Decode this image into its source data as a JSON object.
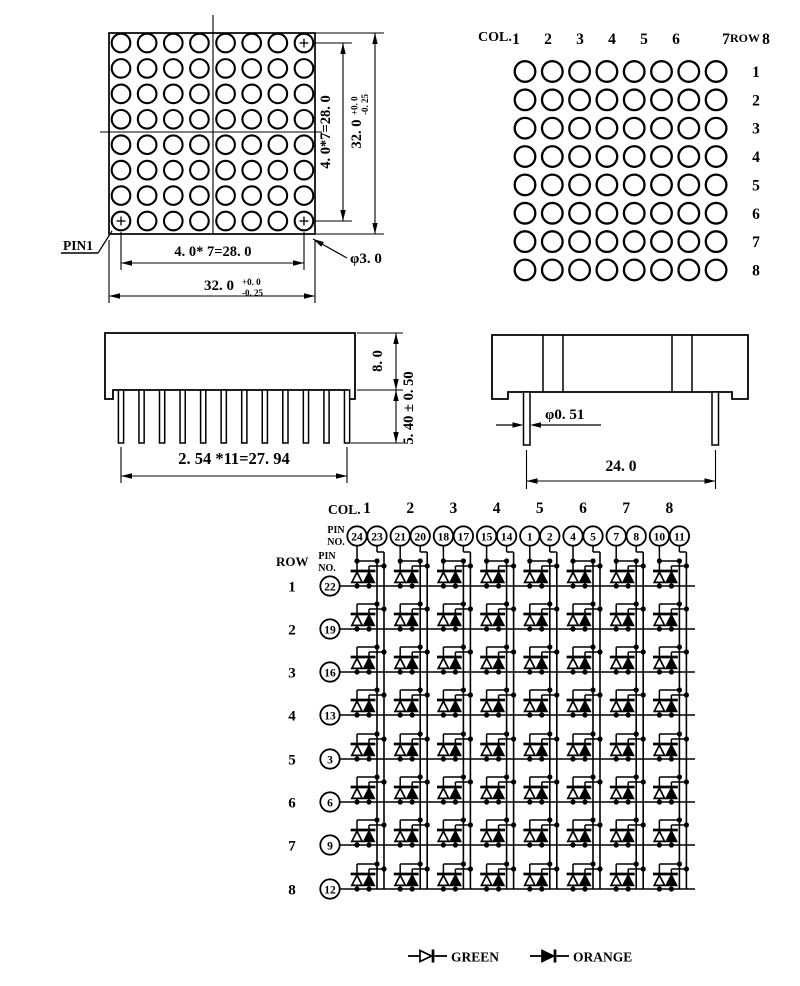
{
  "colors": {
    "ink": "#000000",
    "paper": "#ffffff"
  },
  "front_view": {
    "rows": 8,
    "cols": 8,
    "pin1_label": "PIN1",
    "led_dia": "φ3. 0",
    "dim_row_pitch": "4. 0*7=28. 0",
    "dim_height": "32. 0",
    "dim_height_tol_plus": "+0. 0",
    "dim_height_tol_minus": "-0. 25",
    "dim_col_pitch": "4. 0* 7=28. 0",
    "dim_width": "32. 0",
    "dim_width_tol_plus": "+0. 0",
    "dim_width_tol_minus": "-0. 25"
  },
  "matrix_view": {
    "col_label": "COL.",
    "row_label": "ROW",
    "col_numbers": [
      "1",
      "2",
      "3",
      "4",
      "5",
      "6",
      "7",
      "8"
    ],
    "row_numbers": [
      "1",
      "2",
      "3",
      "4",
      "5",
      "6",
      "7",
      "8"
    ]
  },
  "front_side_view": {
    "pin_count": 12,
    "dim_body_height": "8. 0",
    "dim_pin_length": "5. 40 ± 0. 50",
    "dim_pin_pitch": "2. 54 *11=27. 94"
  },
  "right_side_view": {
    "pin_count": 2,
    "dim_pin_dia": "φ0. 51",
    "dim_pin_span": "24. 0"
  },
  "schematic": {
    "col_label": "COL.",
    "row_label": "ROW",
    "pin_no_label": [
      "PIN",
      "NO."
    ],
    "col_numbers": [
      "1",
      "2",
      "3",
      "4",
      "5",
      "6",
      "7",
      "8"
    ],
    "col_pin_pairs": [
      [
        "24",
        "23"
      ],
      [
        "21",
        "20"
      ],
      [
        "18",
        "17"
      ],
      [
        "15",
        "14"
      ],
      [
        "1",
        "2"
      ],
      [
        "4",
        "5"
      ],
      [
        "7",
        "8"
      ],
      [
        "10",
        "11"
      ]
    ],
    "row_numbers": [
      "1",
      "2",
      "3",
      "4",
      "5",
      "6",
      "7",
      "8"
    ],
    "row_pins": [
      "22",
      "19",
      "16",
      "13",
      "3",
      "6",
      "9",
      "12"
    ],
    "legend": [
      {
        "label": "GREEN",
        "filled": false
      },
      {
        "label": "ORANGE",
        "filled": true
      }
    ]
  }
}
